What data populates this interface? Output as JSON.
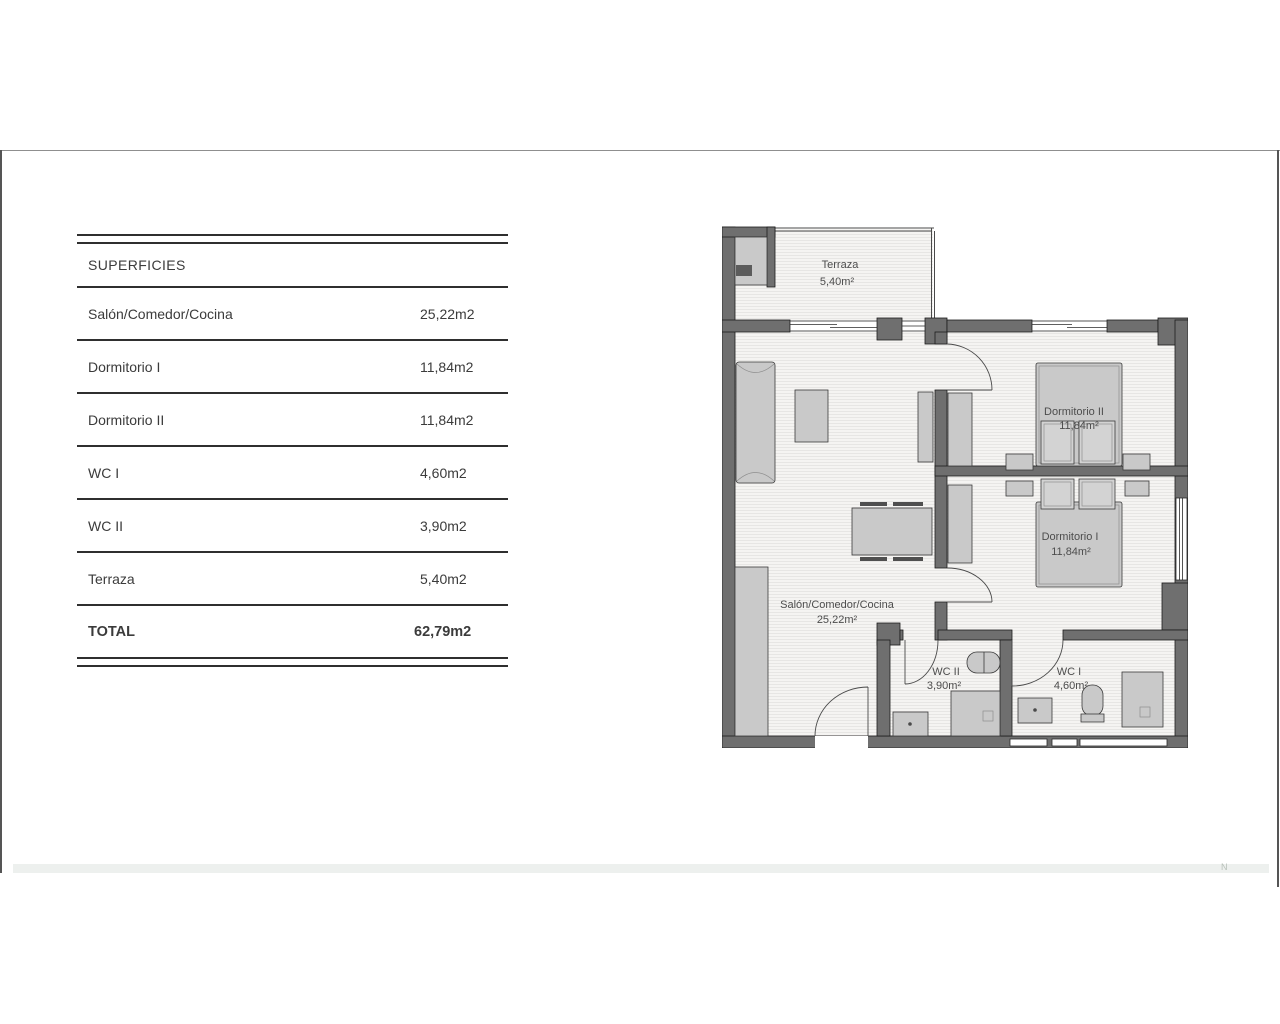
{
  "table": {
    "header": "SUPERFICIES",
    "rows": [
      {
        "label": "Salón/Comedor/Cocina",
        "value": "25,22m2"
      },
      {
        "label": "Dormitorio I",
        "value": "11,84m2"
      },
      {
        "label": "Dormitorio II",
        "value": "11,84m2"
      },
      {
        "label": "WC I",
        "value": "4,60m2"
      },
      {
        "label": "WC II",
        "value": "3,90m2"
      },
      {
        "label": "Terraza",
        "value": "5,40m2"
      }
    ],
    "total": {
      "label": "TOTAL",
      "value": "62,79m2"
    }
  },
  "plan": {
    "rooms": {
      "terraza": {
        "name": "Terraza",
        "area": "5,40m²"
      },
      "dormitorio2": {
        "name": "Dormitorio II",
        "area": "11,84m²"
      },
      "dormitorio1": {
        "name": "Dormitorio I",
        "area": "11,84m²"
      },
      "salon": {
        "name": "Salón/Comedor/Cocina",
        "area": "25,22m²"
      },
      "wc2": {
        "name": "WC II",
        "area": "3,90m²"
      },
      "wc1": {
        "name": "WC I",
        "area": "4,60m²"
      }
    }
  },
  "footer": {
    "mark": "N"
  },
  "colors": {
    "wall": "#6f6f6f",
    "furniture": "#c9c9c9",
    "floor": "#f5f4f2",
    "table_line": "#2f2f2f",
    "bottom_bar": "#edf0ee"
  }
}
